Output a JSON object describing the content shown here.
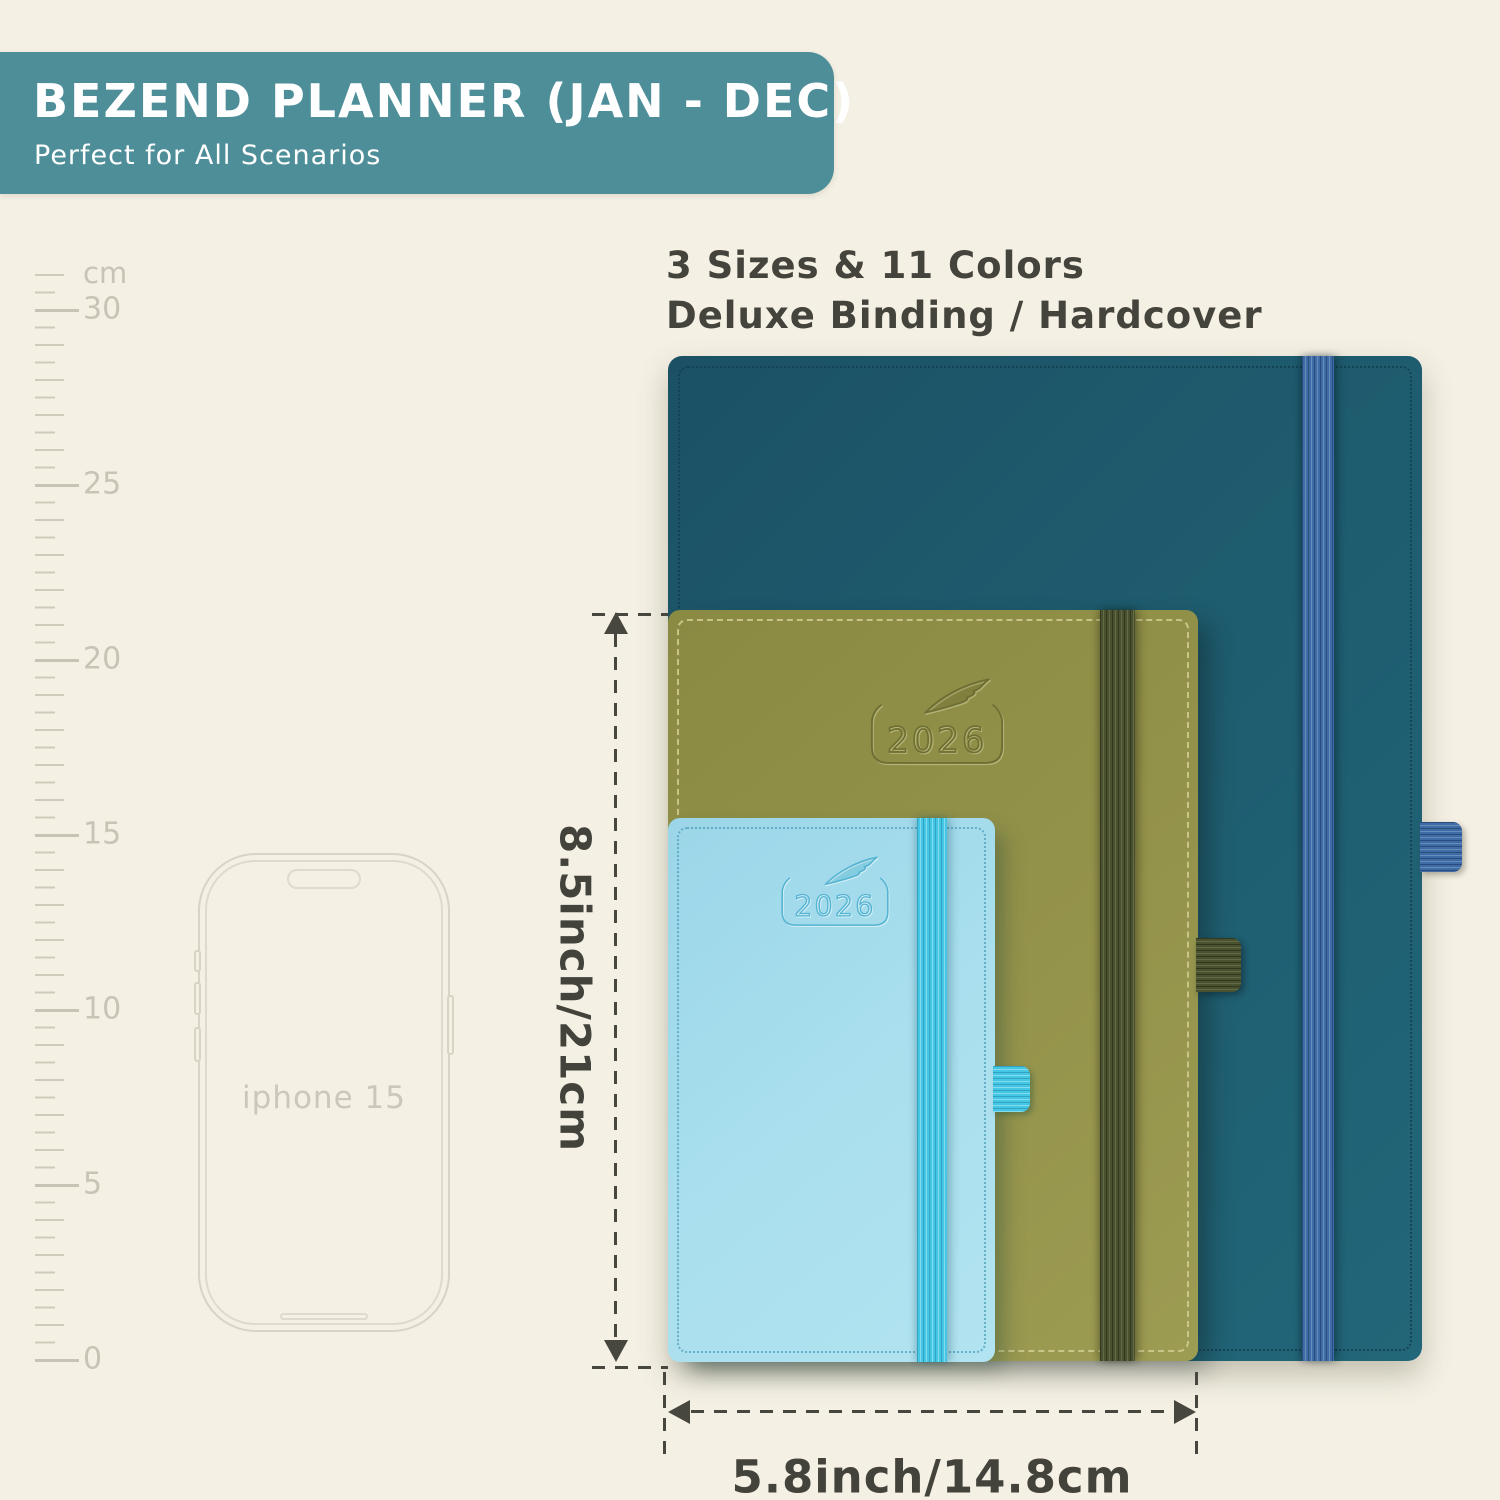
{
  "banner": {
    "title": "BEZEND PLANNER (JAN - DEC)",
    "subtitle": "Perfect for All Scenarios",
    "bg_color": "#4d8e99"
  },
  "headline": {
    "line1": "3 Sizes & 11 Colors",
    "line2": "Deluxe Binding / Hardcover"
  },
  "ruler": {
    "unit_label": "cm",
    "labels": [
      "30",
      "25",
      "20",
      "15",
      "10",
      "5",
      "0"
    ]
  },
  "phone": {
    "label": "iphone 15"
  },
  "planners": {
    "year": "2026",
    "items": [
      {
        "name": "large-teal-planner",
        "cover_color": "#1e5c6f",
        "band_color": "#3d6ca6"
      },
      {
        "name": "medium-olive-planner",
        "cover_color": "#94934b",
        "band_color": "#49512f"
      },
      {
        "name": "small-blue-planner",
        "cover_color": "#a9dfee",
        "band_color": "#43c7e5"
      }
    ]
  },
  "dimensions": {
    "height_label": "8.5inch/21cm",
    "width_label": "5.8inch/14.8cm"
  }
}
